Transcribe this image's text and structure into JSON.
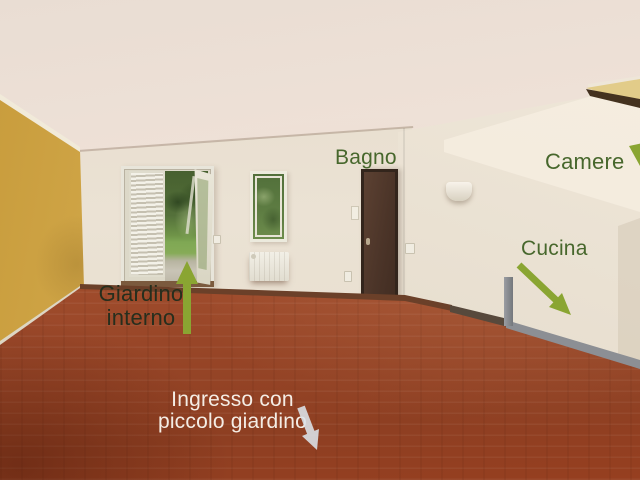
{
  "annotations": {
    "bagno": {
      "label": "Bagno"
    },
    "camere": {
      "label": "Camere"
    },
    "cucina": {
      "label": "Cucina"
    },
    "giardino_interno": {
      "line1": "Giardino",
      "line2": "interno"
    },
    "ingresso": {
      "line1": "Ingresso con",
      "line2": "piccolo giardino"
    }
  },
  "icons": {
    "camere_arrow": "arrowhead-down-right",
    "cucina_arrow": "arrow-down-right",
    "giardino_arrow": "arrow-up",
    "ingresso_arrow": "arrow-down"
  },
  "colors": {
    "label_green": "#47672c",
    "label_dark_green": "#262e1d",
    "label_white": "#f4ede5",
    "arrow_olive": "#8aa532",
    "arrow_white": "#dce3ea",
    "wall_ochre": "#cda143",
    "wall_cream": "#eae1d3",
    "floor_terracotta": "#a35130",
    "door_dark_brown": "#4d362a"
  }
}
